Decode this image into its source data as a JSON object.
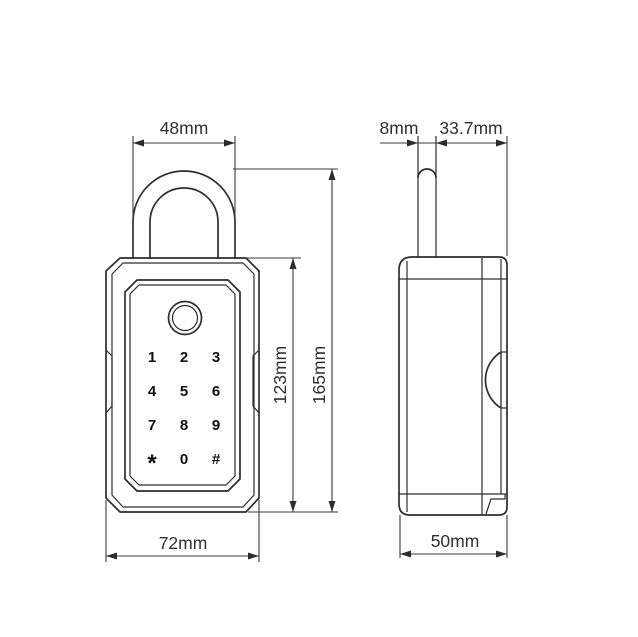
{
  "front_view": {
    "keypad_keys": [
      "1",
      "2",
      "3",
      "4",
      "5",
      "6",
      "7",
      "8",
      "9",
      "*",
      "0",
      "#"
    ],
    "sensor_icon": "fingerprint-sensor-icon"
  },
  "dimensions": {
    "shackle_outer_width": "48mm",
    "shackle_thickness": "8mm",
    "shackle_to_back": "33.7mm",
    "body_height": "123mm",
    "overall_height": "165mm",
    "body_width": "72mm",
    "body_depth": "50mm"
  },
  "colors": {
    "line": "#2d2d2d",
    "text": "#2f2f2f",
    "background": "#ffffff"
  }
}
